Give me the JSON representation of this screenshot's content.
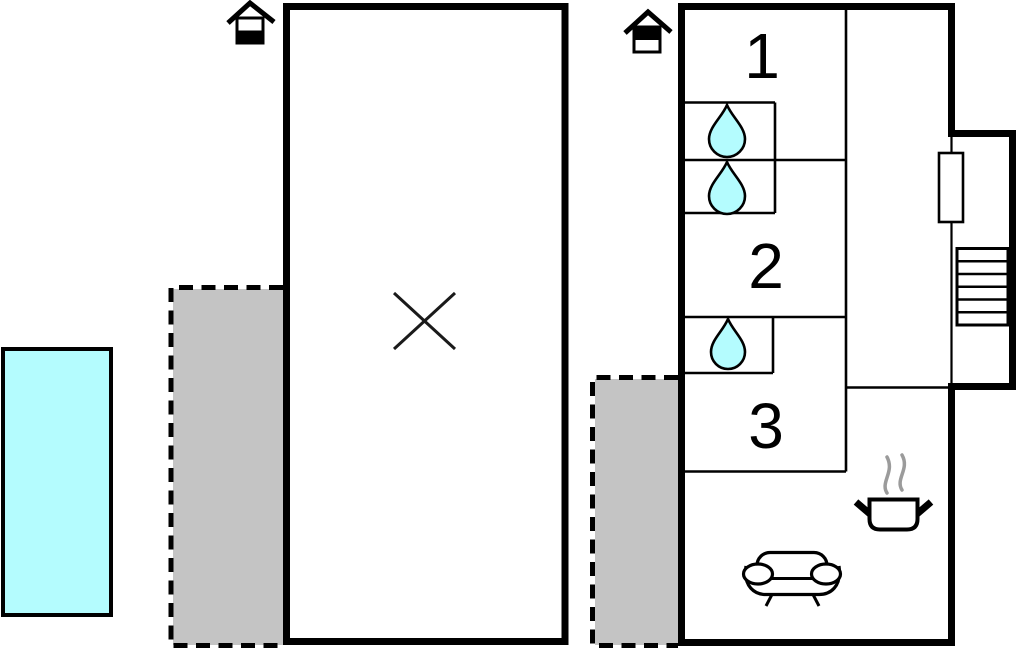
{
  "page": {
    "type": "floor-plan",
    "background": "#ffffff",
    "width": 1017,
    "height": 652
  },
  "colors": {
    "wall": "#000000",
    "water": "#b4fcfe",
    "terrace": "#c4c4c4",
    "steam": "#9b9b9b"
  },
  "rooms": [
    {
      "label": "1"
    },
    {
      "label": "2"
    },
    {
      "label": "3"
    }
  ],
  "features": {
    "pool": {
      "shape": "rectangle",
      "fill": "water"
    },
    "terraces": [
      {
        "position": "left-of-annex",
        "style": "dashed-outline-gray"
      },
      {
        "position": "left-of-main-house",
        "style": "dashed-outline-gray"
      }
    ],
    "bathroom_drops": 3,
    "stairs_treads": 6
  },
  "icons": [
    {
      "name": "floor-level-house-icon-annex",
      "meaning": "house icon, lower level filled"
    },
    {
      "name": "floor-level-house-icon-main",
      "meaning": "house icon, upper level filled"
    },
    {
      "name": "x-mark-icon",
      "meaning": "crossed-lines mark in annex room"
    },
    {
      "name": "water-drop-icon",
      "meaning": "bathroom / water point"
    },
    {
      "name": "door-icon",
      "meaning": "door leaf rectangle at stairwell"
    },
    {
      "name": "stairs-icon",
      "meaning": "staircase treads"
    },
    {
      "name": "stove-icon",
      "meaning": "cooking pot with steam (kitchen)"
    },
    {
      "name": "sofa-icon",
      "meaning": "sofa (living room)"
    }
  ]
}
